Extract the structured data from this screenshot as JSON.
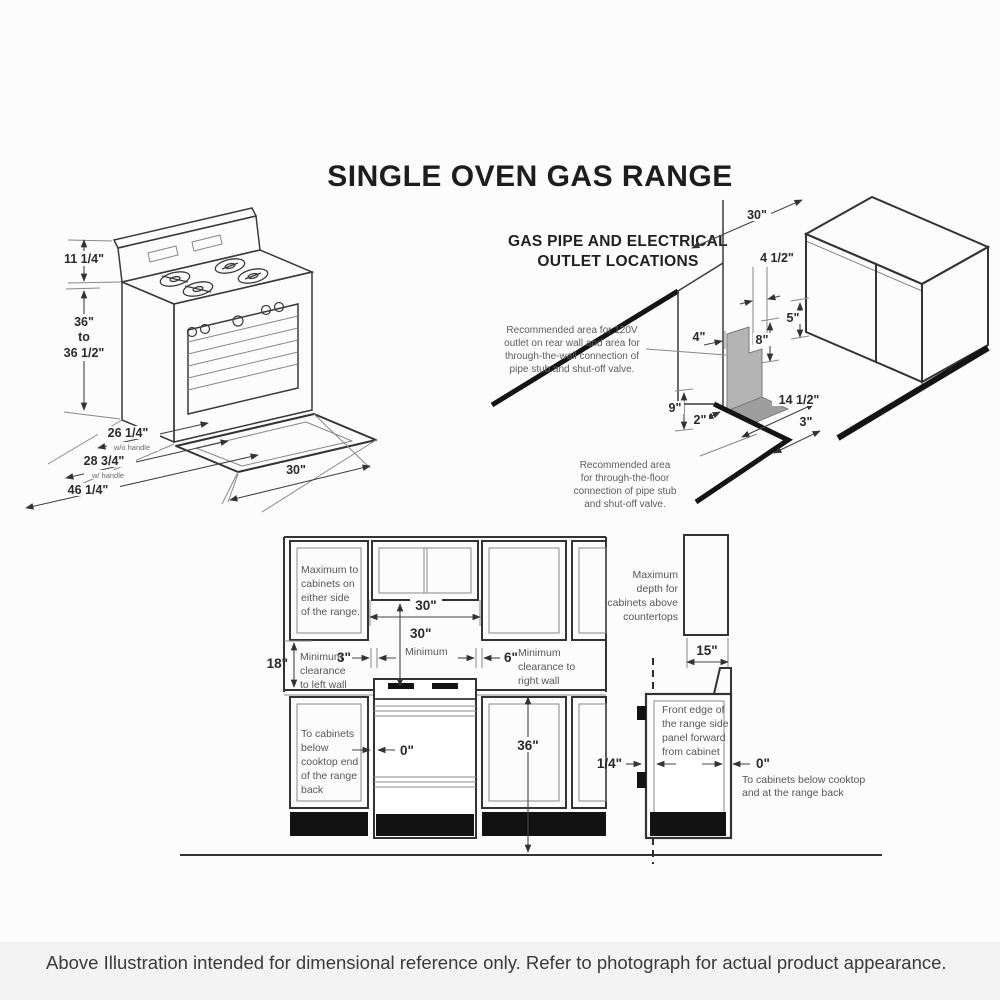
{
  "title": "SINGLE OVEN GAS RANGE",
  "footer": "Above Illustration intended for dimensional reference only. Refer to photograph for actual product appearance.",
  "iso": {
    "backsplash_height": "11 1/4\"",
    "height_min": "36\"",
    "height_to": "to",
    "height_max": "36 1/2\"",
    "depth_wo_handle": "26 1/4\"",
    "depth_wo_handle_note": "w/o handle",
    "depth_w_handle": "28 3/4\"",
    "depth_w_handle_note": "w/ handle",
    "depth_total": "46 1/4\"",
    "width": "30\""
  },
  "gas": {
    "heading1": "GAS PIPE AND ELECTRICAL",
    "heading2": "OUTLET LOCATIONS",
    "wall_note": [
      "Recommended area for 120V",
      "outlet on rear wall and area for",
      "through-the-wall connection of",
      "pipe stub and shut-off valve."
    ],
    "floor_note": [
      "Recommended area",
      "for through-the-floor",
      "connection of pipe stub",
      "and shut-off valve."
    ],
    "dim_opening": "30\"",
    "dim_4half": "4 1/2\"",
    "dim_5": "5\"",
    "dim_4": "4\"",
    "dim_8": "8\"",
    "dim_9": "9\"",
    "dim_2": "2\"",
    "dim_14half": "14 1/2\"",
    "dim_3": "3\""
  },
  "elev": {
    "upper_note": [
      "Maximum to",
      "cabinets on",
      "either side",
      "of the range."
    ],
    "opening_width": "30\"",
    "min_height": "30\"",
    "min_height_word": "Minimum",
    "gap_left": "3\"",
    "gap_right": "6\"",
    "right_wall_note": [
      "Minimum",
      "clearance to",
      "right wall"
    ],
    "upper_clearance": "18\"",
    "left_wall_note": [
      "Minimum",
      "clearance",
      "to left wall"
    ],
    "base_note": [
      "To cabinets",
      "below",
      "cooktop end",
      "of the range",
      "back"
    ],
    "zero": "0\"",
    "counter_height": "36\""
  },
  "side": {
    "depth_note": [
      "Maximum",
      "depth for",
      "cabinets above",
      "countertops"
    ],
    "cab_depth": "15\"",
    "front_note": [
      "Front edge of",
      "the range side",
      "panel forward",
      "from cabinet"
    ],
    "quarter": "1/4\"",
    "zero": "0\"",
    "zero_note": [
      "To cabinets below cooktop",
      "and at the range back"
    ]
  }
}
